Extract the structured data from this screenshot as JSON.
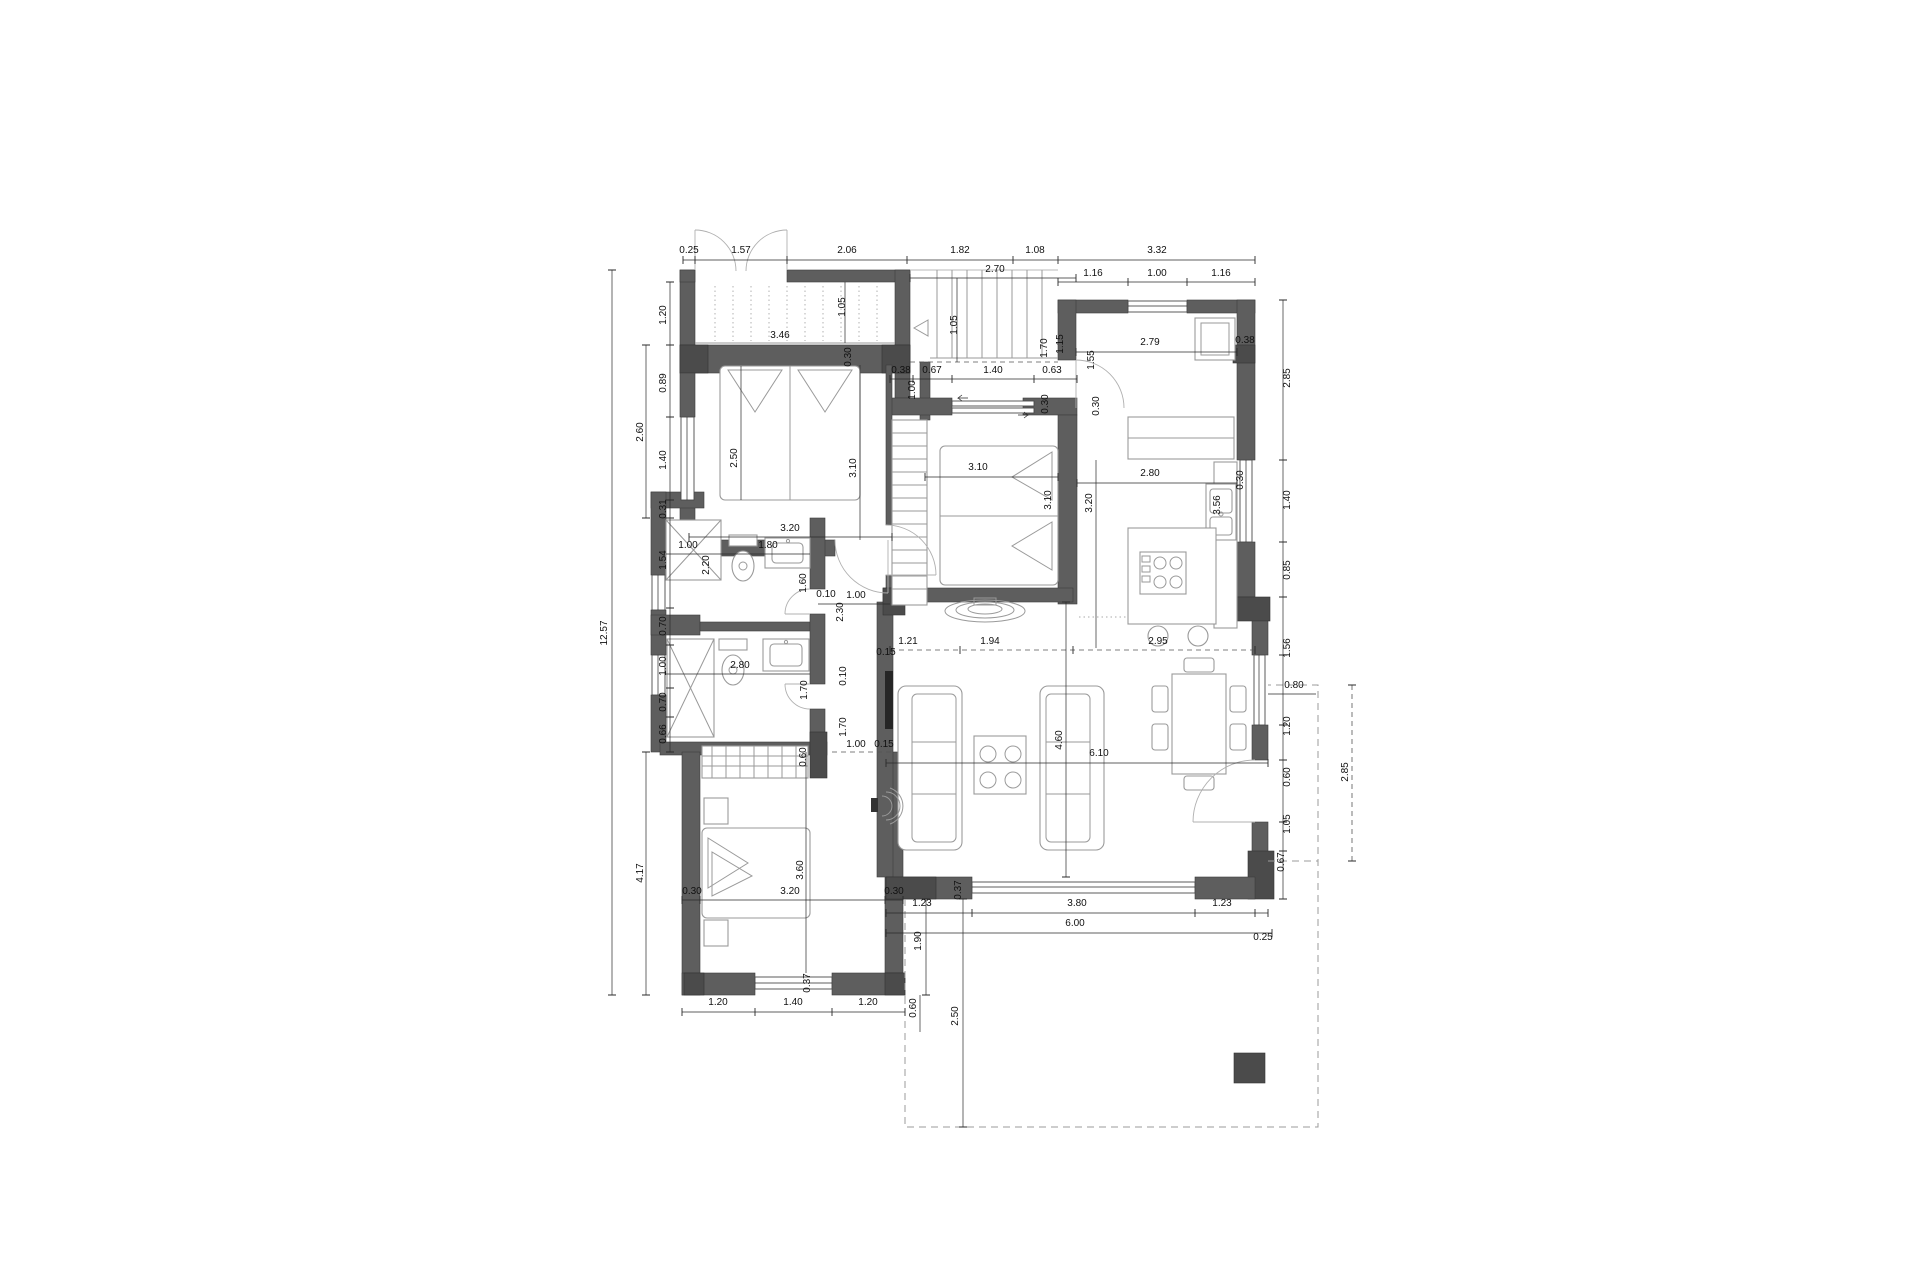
{
  "drawing": {
    "type": "architectural-floor-plan",
    "view": "ground floor plan with dimension chains (meters)",
    "wall_color": "#5e5e5e",
    "pillar_color": "#4b4b4b",
    "background": "#ffffff",
    "furniture_items": [
      "double-bed",
      "single-bed",
      "wardrobe",
      "shower",
      "toilet",
      "washbasin",
      "kitchen-sink",
      "stove",
      "fridge",
      "kitchen-island",
      "bar-stool",
      "sofa",
      "coffee-table",
      "dining-table",
      "chair",
      "tv",
      "staircase",
      "terrace",
      "pillar"
    ]
  },
  "dimensions": [
    {
      "t": "0.25",
      "x": 689,
      "y": 253,
      "r": 0
    },
    {
      "t": "1.57",
      "x": 741,
      "y": 253,
      "r": 0
    },
    {
      "t": "2.06",
      "x": 847,
      "y": 253,
      "r": 0
    },
    {
      "t": "1.82",
      "x": 960,
      "y": 253,
      "r": 0
    },
    {
      "t": "1.08",
      "x": 1035,
      "y": 253,
      "r": 0
    },
    {
      "t": "3.32",
      "x": 1157,
      "y": 253,
      "r": 0
    },
    {
      "t": "1.16",
      "x": 1093,
      "y": 276,
      "r": 0
    },
    {
      "t": "1.00",
      "x": 1157,
      "y": 276,
      "r": 0
    },
    {
      "t": "1.16",
      "x": 1221,
      "y": 276,
      "r": 0
    },
    {
      "t": "2.70",
      "x": 995,
      "y": 272,
      "r": 0
    },
    {
      "t": "1.05",
      "x": 957,
      "y": 325,
      "r": 1
    },
    {
      "t": "3.46",
      "x": 780,
      "y": 338,
      "r": 0
    },
    {
      "t": "1.05",
      "x": 845,
      "y": 307,
      "r": 1
    },
    {
      "t": "0.38",
      "x": 901,
      "y": 373,
      "r": 0
    },
    {
      "t": "0.67",
      "x": 932,
      "y": 373,
      "r": 0
    },
    {
      "t": "1.40",
      "x": 993,
      "y": 373,
      "r": 0
    },
    {
      "t": "0.63",
      "x": 1052,
      "y": 373,
      "r": 0
    },
    {
      "t": "1.00",
      "x": 915,
      "y": 390,
      "r": 1
    },
    {
      "t": "1.70",
      "x": 1047,
      "y": 348,
      "r": 1
    },
    {
      "t": "1.15",
      "x": 1063,
      "y": 344,
      "r": 1
    },
    {
      "t": "1.55",
      "x": 1094,
      "y": 360,
      "r": 1
    },
    {
      "t": "0.30",
      "x": 1048,
      "y": 404,
      "r": 1
    },
    {
      "t": "0.30",
      "x": 1099,
      "y": 406,
      "r": 1
    },
    {
      "t": "0.30",
      "x": 851,
      "y": 357,
      "r": 1
    },
    {
      "t": "2.79",
      "x": 1150,
      "y": 345,
      "r": 0
    },
    {
      "t": "0.38",
      "x": 1245,
      "y": 343,
      "r": 0
    },
    {
      "t": "2.85",
      "x": 1290,
      "y": 378,
      "r": 1
    },
    {
      "t": "1.20",
      "x": 666,
      "y": 315,
      "r": 1
    },
    {
      "t": "0.89",
      "x": 666,
      "y": 383,
      "r": 1
    },
    {
      "t": "1.40",
      "x": 666,
      "y": 460,
      "r": 1
    },
    {
      "t": "0.31",
      "x": 666,
      "y": 509,
      "r": 1
    },
    {
      "t": "1.54",
      "x": 666,
      "y": 560,
      "r": 1
    },
    {
      "t": "0.70",
      "x": 666,
      "y": 626,
      "r": 1
    },
    {
      "t": "1.00",
      "x": 666,
      "y": 666,
      "r": 1
    },
    {
      "t": "0.70",
      "x": 666,
      "y": 702,
      "r": 1
    },
    {
      "t": "0.66",
      "x": 666,
      "y": 734,
      "r": 1
    },
    {
      "t": "2.60",
      "x": 643,
      "y": 432,
      "r": 1
    },
    {
      "t": "4.17",
      "x": 643,
      "y": 873,
      "r": 1
    },
    {
      "t": "12.57",
      "x": 607,
      "y": 633,
      "r": 1
    },
    {
      "t": "2.50",
      "x": 737,
      "y": 458,
      "r": 1
    },
    {
      "t": "3.10",
      "x": 856,
      "y": 468,
      "r": 1
    },
    {
      "t": "3.20",
      "x": 790,
      "y": 531,
      "r": 0
    },
    {
      "t": "1.00",
      "x": 688,
      "y": 548,
      "r": 0
    },
    {
      "t": "1.80",
      "x": 768,
      "y": 548,
      "r": 0
    },
    {
      "t": "2.20",
      "x": 709,
      "y": 565,
      "r": 1
    },
    {
      "t": "1.60",
      "x": 806,
      "y": 583,
      "r": 1
    },
    {
      "t": "2.80",
      "x": 740,
      "y": 668,
      "r": 0
    },
    {
      "t": "1.70",
      "x": 807,
      "y": 690,
      "r": 1
    },
    {
      "t": "0.10",
      "x": 826,
      "y": 597,
      "r": 0
    },
    {
      "t": "1.00",
      "x": 856,
      "y": 598,
      "r": 0
    },
    {
      "t": "2.30",
      "x": 843,
      "y": 612,
      "r": 1
    },
    {
      "t": "0.10",
      "x": 846,
      "y": 676,
      "r": 1
    },
    {
      "t": "1.70",
      "x": 846,
      "y": 727,
      "r": 1
    },
    {
      "t": "0.15",
      "x": 886,
      "y": 655,
      "r": 0
    },
    {
      "t": "1.00",
      "x": 856,
      "y": 747,
      "r": 0
    },
    {
      "t": "0.15",
      "x": 884,
      "y": 747,
      "r": 0
    },
    {
      "t": "1.21",
      "x": 908,
      "y": 644,
      "r": 0
    },
    {
      "t": "1.94",
      "x": 990,
      "y": 644,
      "r": 0
    },
    {
      "t": "2.95",
      "x": 1158,
      "y": 644,
      "r": 0
    },
    {
      "t": "3.10",
      "x": 978,
      "y": 470,
      "r": 0
    },
    {
      "t": "3.10",
      "x": 1051,
      "y": 500,
      "r": 1
    },
    {
      "t": "2.80",
      "x": 1150,
      "y": 476,
      "r": 0
    },
    {
      "t": "0.30",
      "x": 1243,
      "y": 480,
      "r": 1
    },
    {
      "t": "3.56",
      "x": 1220,
      "y": 505,
      "r": 1
    },
    {
      "t": "3.20",
      "x": 1092,
      "y": 503,
      "r": 1
    },
    {
      "t": "1.40",
      "x": 1290,
      "y": 500,
      "r": 1
    },
    {
      "t": "0.85",
      "x": 1290,
      "y": 570,
      "r": 1
    },
    {
      "t": "1.56",
      "x": 1290,
      "y": 648,
      "r": 1
    },
    {
      "t": "0.80",
      "x": 1294,
      "y": 688,
      "r": 0
    },
    {
      "t": "1.20",
      "x": 1290,
      "y": 726,
      "r": 1
    },
    {
      "t": "0.60",
      "x": 1290,
      "y": 777,
      "r": 1
    },
    {
      "t": "1.05",
      "x": 1290,
      "y": 824,
      "r": 1
    },
    {
      "t": "0.67",
      "x": 1284,
      "y": 862,
      "r": 1
    },
    {
      "t": "2.85",
      "x": 1348,
      "y": 772,
      "r": 1
    },
    {
      "t": "4.60",
      "x": 1062,
      "y": 740,
      "r": 1
    },
    {
      "t": "6.10",
      "x": 1099,
      "y": 756,
      "r": 0
    },
    {
      "t": "0.37",
      "x": 961,
      "y": 890,
      "r": 1
    },
    {
      "t": "1.23",
      "x": 922,
      "y": 906,
      "r": 0
    },
    {
      "t": "3.80",
      "x": 1077,
      "y": 906,
      "r": 0
    },
    {
      "t": "1.23",
      "x": 1222,
      "y": 906,
      "r": 0
    },
    {
      "t": "6.00",
      "x": 1075,
      "y": 926,
      "r": 0
    },
    {
      "t": "0.25",
      "x": 1263,
      "y": 940,
      "r": 0
    },
    {
      "t": "1.90",
      "x": 921,
      "y": 941,
      "r": 1
    },
    {
      "t": "2.50",
      "x": 958,
      "y": 1016,
      "r": 1
    },
    {
      "t": "0.60",
      "x": 806,
      "y": 757,
      "r": 1
    },
    {
      "t": "3.60",
      "x": 803,
      "y": 870,
      "r": 1
    },
    {
      "t": "3.20",
      "x": 790,
      "y": 894,
      "r": 0
    },
    {
      "t": "0.30",
      "x": 692,
      "y": 894,
      "r": 0
    },
    {
      "t": "0.30",
      "x": 894,
      "y": 894,
      "r": 0
    },
    {
      "t": "0.37",
      "x": 810,
      "y": 983,
      "r": 1
    },
    {
      "t": "1.20",
      "x": 718,
      "y": 1005,
      "r": 0
    },
    {
      "t": "1.40",
      "x": 793,
      "y": 1005,
      "r": 0
    },
    {
      "t": "1.20",
      "x": 868,
      "y": 1005,
      "r": 0
    },
    {
      "t": "0.60",
      "x": 916,
      "y": 1008,
      "r": 1
    }
  ]
}
